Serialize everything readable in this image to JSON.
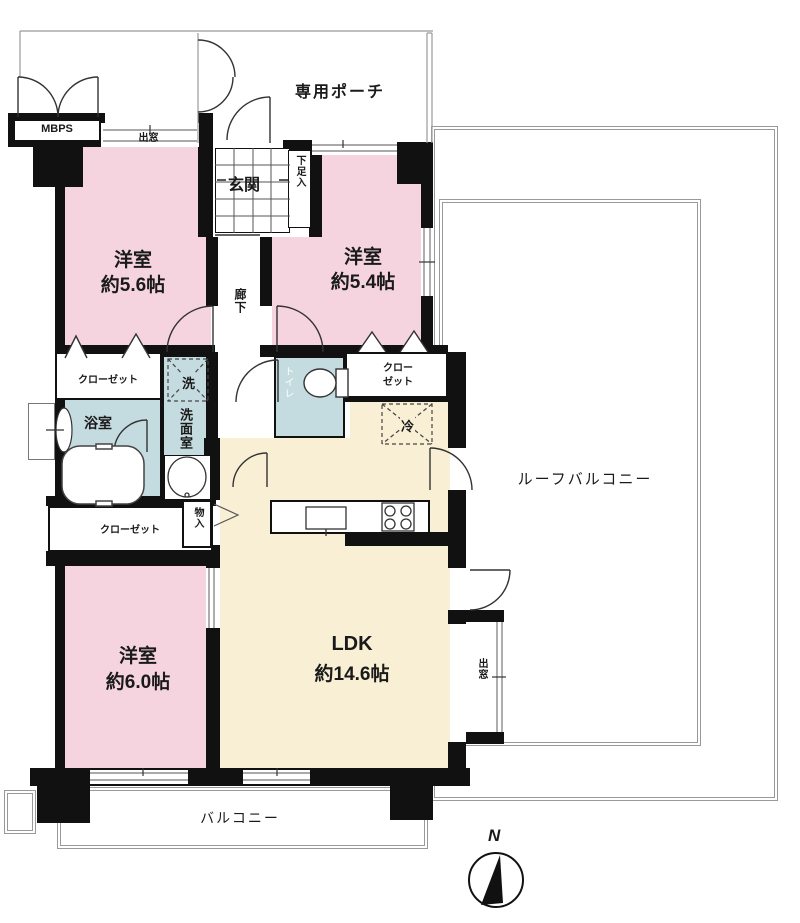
{
  "labels": {
    "private_porch": "専用ポーチ",
    "mbps": "MBPS",
    "bay_window": "出窓",
    "entrance": "玄関",
    "shoe_cabinet": "下足入",
    "hallway": "廊下",
    "western_room": "洋室",
    "room1_size": "約5.6帖",
    "room2_size": "約5.4帖",
    "room3_size": "約6.0帖",
    "closet": "クローゼット",
    "closet_wrap_line1": "クロー",
    "closet_wrap_line2": "ゼット",
    "washer": "洗",
    "bathroom": "浴室",
    "washroom": "洗面室",
    "toilet": "トイレ",
    "refrigerator": "冷",
    "storage": "物入",
    "ldk": "LDK",
    "ldk_size": "約14.6帖",
    "roof_balcony": "ルーフバルコニー",
    "balcony": "バルコニー",
    "compass_north": "N"
  },
  "colors": {
    "room_pink": "#f5d4e0",
    "ldk_cream": "#f8efd5",
    "wet_area_blue": "#c4dbdf",
    "wall_black": "#111111",
    "outline_gray": "#999999"
  }
}
